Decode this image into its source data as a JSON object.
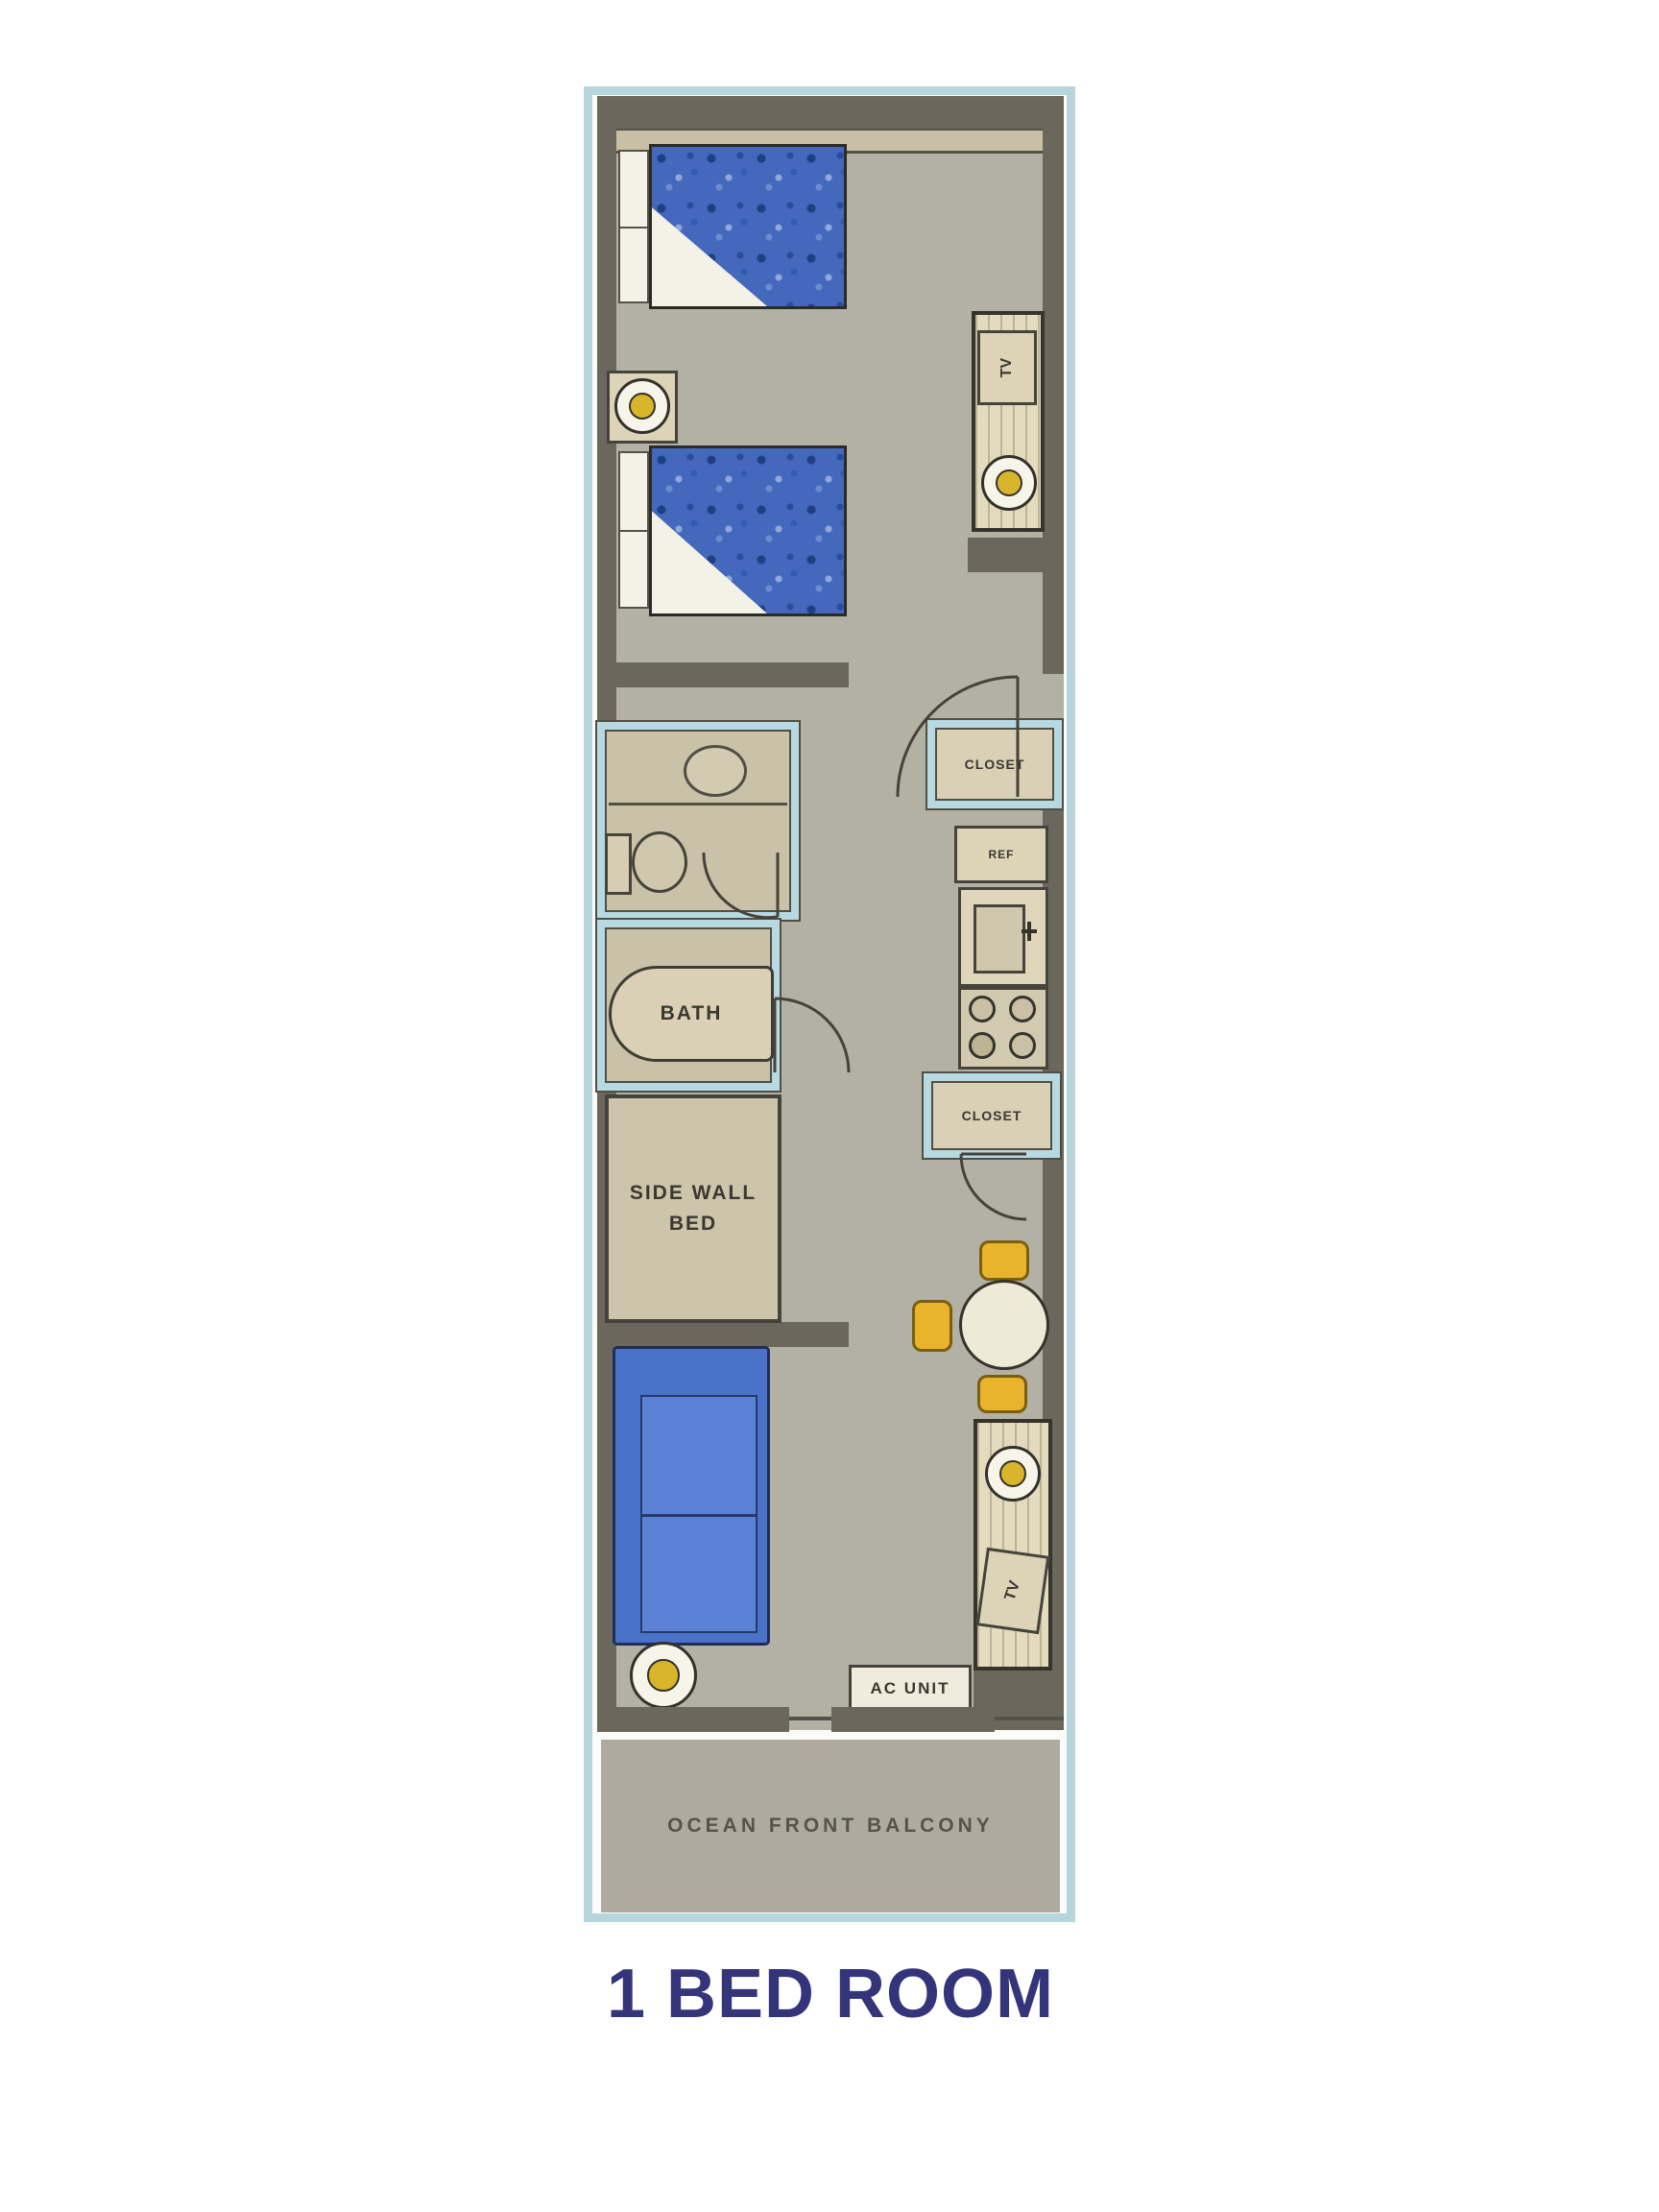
{
  "title": "1 BED ROOM",
  "plan": {
    "labels": {
      "tv_upper": "TV",
      "closet_upper": "CLOSET",
      "fridge": "REF",
      "bath": "BATH",
      "closet_lower": "CLOSET",
      "side_wall_bed_line1": "SIDE WALL",
      "side_wall_bed_line2": "BED",
      "tv_lower": "TV",
      "ac_unit": "AC UNIT",
      "balcony": "OCEAN FRONT BALCONY"
    },
    "colors": {
      "frame_blue": "#b7d5dd",
      "bathroom_wall_blue": "#b7d9e2",
      "wall": "#6b675c",
      "floor": "#b3b0a4",
      "bed_blue": "#4468bc",
      "sofa_blue": "#4a72c8",
      "chair_yellow": "#e9b42c",
      "cabinet_wood": "#e4dbbf",
      "balcony_floor": "#aeab9e",
      "title_text": "#34347b",
      "label_text": "#3b382f"
    }
  }
}
